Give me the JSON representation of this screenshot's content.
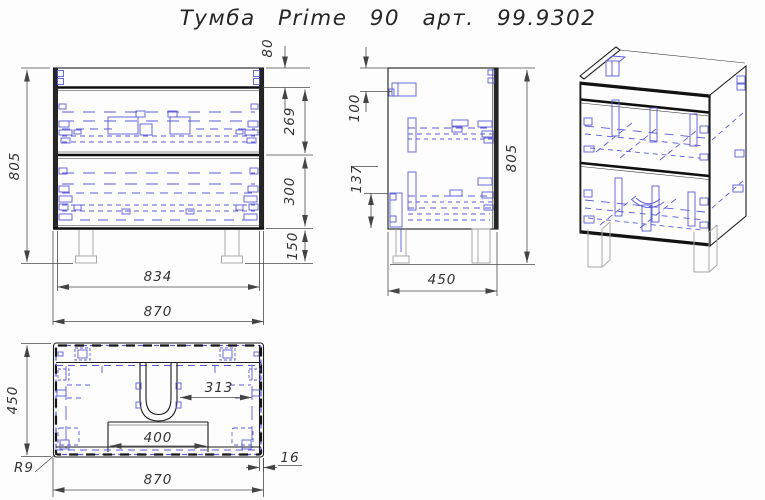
{
  "title": "Тумба Prime 90 арт. 99.9302",
  "colors": {
    "visible_line": "#1c1c1c",
    "hidden_line": "#5b5bd8",
    "dimension_line": "#4a4a4a",
    "legs_line": "#aaaaaa",
    "background": "#fdfdfd"
  },
  "views": {
    "front": {
      "dims": {
        "height": "805",
        "top_rail": "80",
        "drawer_top": "269",
        "drawer_bottom": "300",
        "legs": "150",
        "inner_width": "834",
        "width": "870"
      }
    },
    "side": {
      "dims": {
        "bracket_from_top": "100",
        "bracket_height": "137",
        "height": "805",
        "depth": "450"
      }
    },
    "plan": {
      "dims": {
        "depth": "450",
        "corner_radius": "R9",
        "width": "870",
        "wall_thickness": "16",
        "drain_offset": "313",
        "drain_shelf": "400"
      }
    }
  }
}
